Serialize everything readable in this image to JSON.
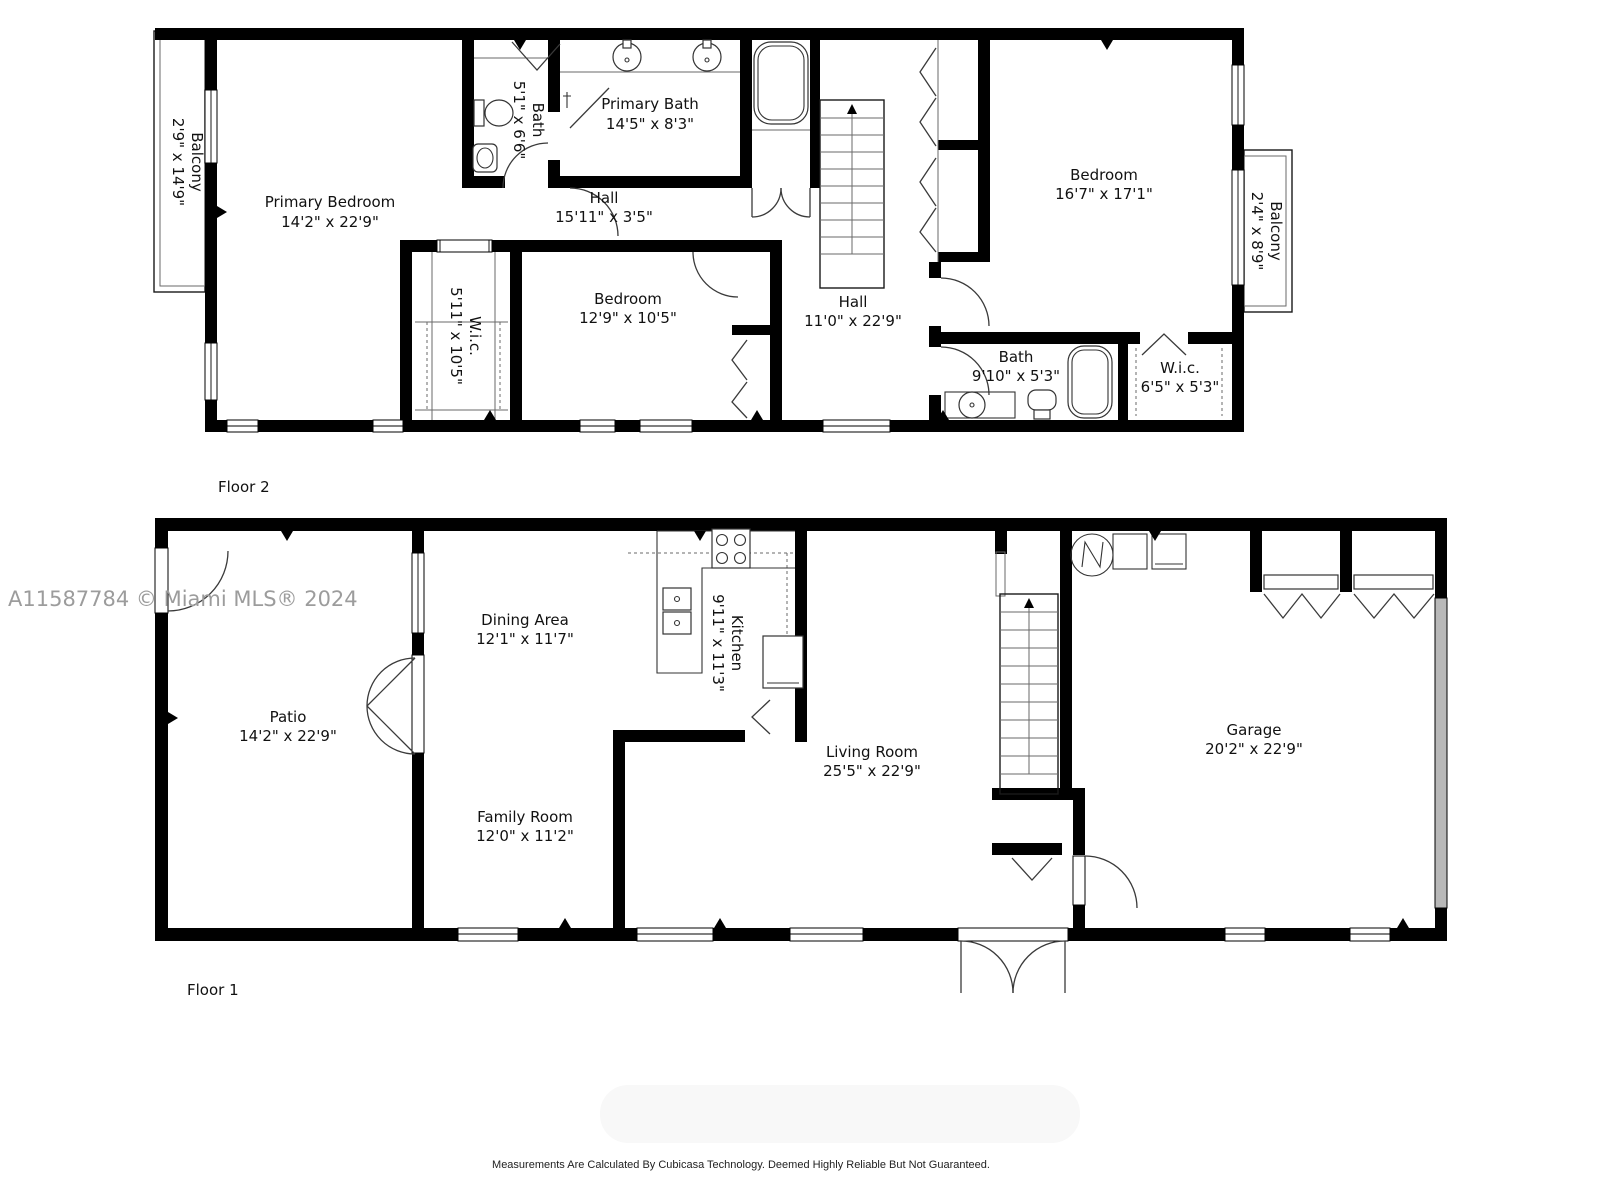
{
  "watermark": "A11587784 © Miami MLS® 2024",
  "footer": "Measurements Are Calculated By Cubicasa Technology. Deemed Highly Reliable But Not Guaranteed.",
  "floor2": {
    "label": "Floor 2",
    "rooms": {
      "balcony_left": {
        "name": "Balcony",
        "dims": "2'9\" x 14'9\""
      },
      "primary_bedroom": {
        "name": "Primary Bedroom",
        "dims": "14'2\" x 22'9\""
      },
      "bath": {
        "name": "Bath",
        "dims": "5'1\" x 6'6\""
      },
      "primary_bath": {
        "name": "Primary Bath",
        "dims": "14'5\" x 8'3\""
      },
      "hall_top": {
        "name": "Hall",
        "dims": "15'11\" x 3'5\""
      },
      "wic_left": {
        "name": "W.i.c.",
        "dims": "5'11\" x 10'5\""
      },
      "bedroom_mid": {
        "name": "Bedroom",
        "dims": "12'9\" x 10'5\""
      },
      "hall_mid": {
        "name": "Hall",
        "dims": "11'0\" x 22'9\""
      },
      "bedroom_right": {
        "name": "Bedroom",
        "dims": "16'7\" x 17'1\""
      },
      "balcony_right": {
        "name": "Balcony",
        "dims": "2'4\" x 8'9\""
      },
      "bath_right": {
        "name": "Bath",
        "dims": "9'10\" x 5'3\""
      },
      "wic_right": {
        "name": "W.i.c.",
        "dims": "6'5\" x 5'3\""
      }
    }
  },
  "floor1": {
    "label": "Floor 1",
    "rooms": {
      "patio": {
        "name": "Patio",
        "dims": "14'2\" x 22'9\""
      },
      "dining": {
        "name": "Dining Area",
        "dims": "12'1\" x 11'7\""
      },
      "kitchen": {
        "name": "Kitchen",
        "dims": "9'11\" x 11'3\""
      },
      "living": {
        "name": "Living Room",
        "dims": "25'5\" x 22'9\""
      },
      "family": {
        "name": "Family Room",
        "dims": "12'0\" x 11'2\""
      },
      "garage": {
        "name": "Garage",
        "dims": "20'2\" x 22'9\""
      }
    }
  }
}
